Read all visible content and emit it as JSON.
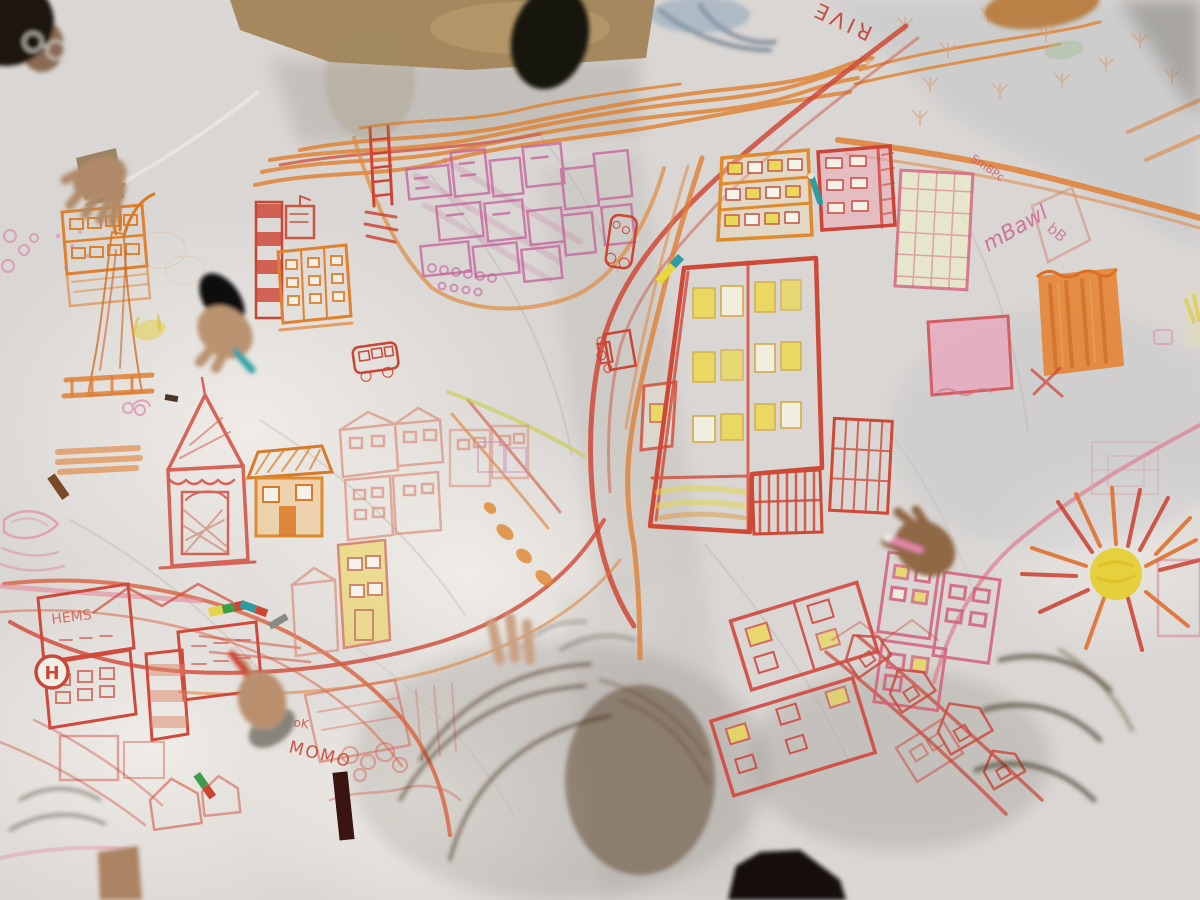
{
  "scene": {
    "type": "photograph",
    "setting": "Overhead photo of children and adults kneeling around a large white cloth on the floor, drawing a town map with crayons",
    "texts": {
      "river_label": "RIVE",
      "momo": "MOMO",
      "ok_mark": "oK",
      "building_sign": "HEMS",
      "hospital_letter": "H",
      "signature_large": "mBawl",
      "signature_small": "SmBPc",
      "signature_box": "bB"
    },
    "palette": {
      "sheet": "#d9d6d3",
      "floor": "#a5885e",
      "crayon_orange": "#e0812e",
      "crayon_red": "#cf4936",
      "crayon_pink": "#d4607a",
      "crayon_magenta": "#c4609a",
      "crayon_yellow": "#e8d23c",
      "sun_yellow": "#e6cd2a",
      "denim_blue": "#5b7591",
      "khaki": "#6e6349",
      "olive_jacket": "#564832",
      "skin": "#b48c68",
      "hair_dark": "#241a12"
    }
  }
}
